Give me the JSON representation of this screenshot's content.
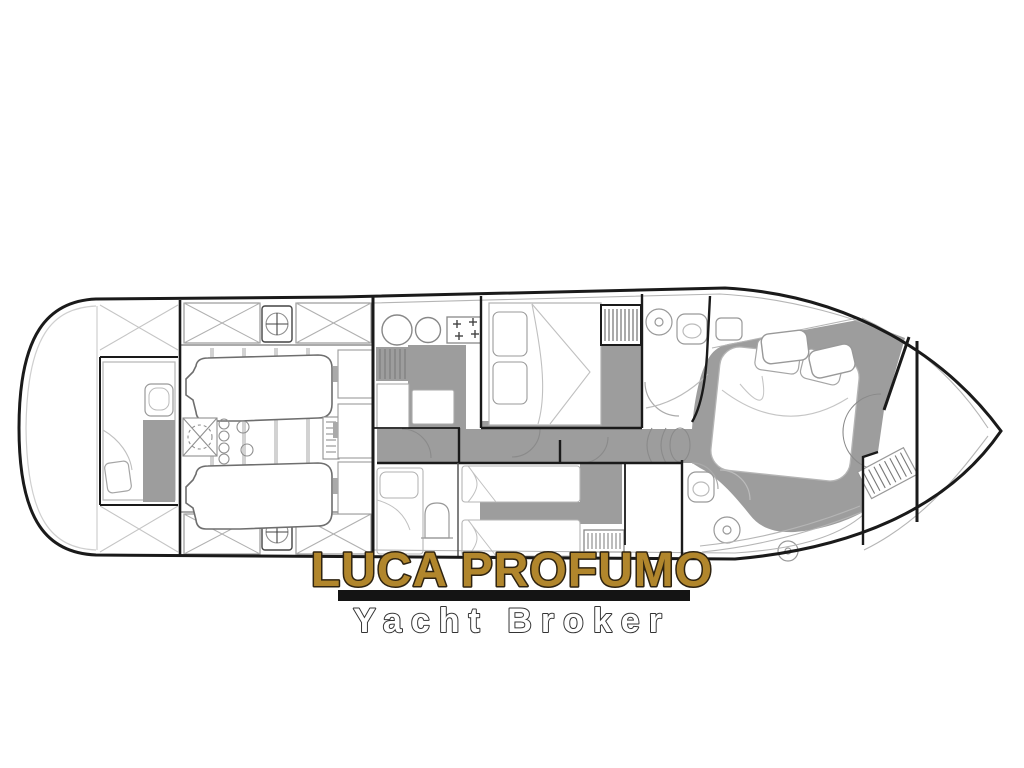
{
  "page": {
    "background_color": "#ffffff"
  },
  "watermark": {
    "brand": "LUCA PROFUMO",
    "subtitle": "Yacht Broker",
    "brand_color": "#b1862c",
    "brand_outline_color": "#2e2310",
    "divider_color": "#141414",
    "subtitle_color": "#ffffff",
    "subtitle_outline_color": "#343434"
  },
  "floorplan": {
    "type": "yacht-lower-deck-plan",
    "orientation": "bow-right",
    "hull_line_color": "#1a1a1a",
    "wall_color": "#1a1a1a",
    "floor_color": "#9d9d9d",
    "furniture_line_color": "#a8a8a8",
    "areas": [
      "swim-platform",
      "crew-cabin",
      "engine-room",
      "midship-storage",
      "galley",
      "companionway-stairs",
      "corridor",
      "vip-cabin",
      "forward-bathroom",
      "guest-cabin",
      "aft-bathroom",
      "master-cabin",
      "foredeck"
    ]
  }
}
